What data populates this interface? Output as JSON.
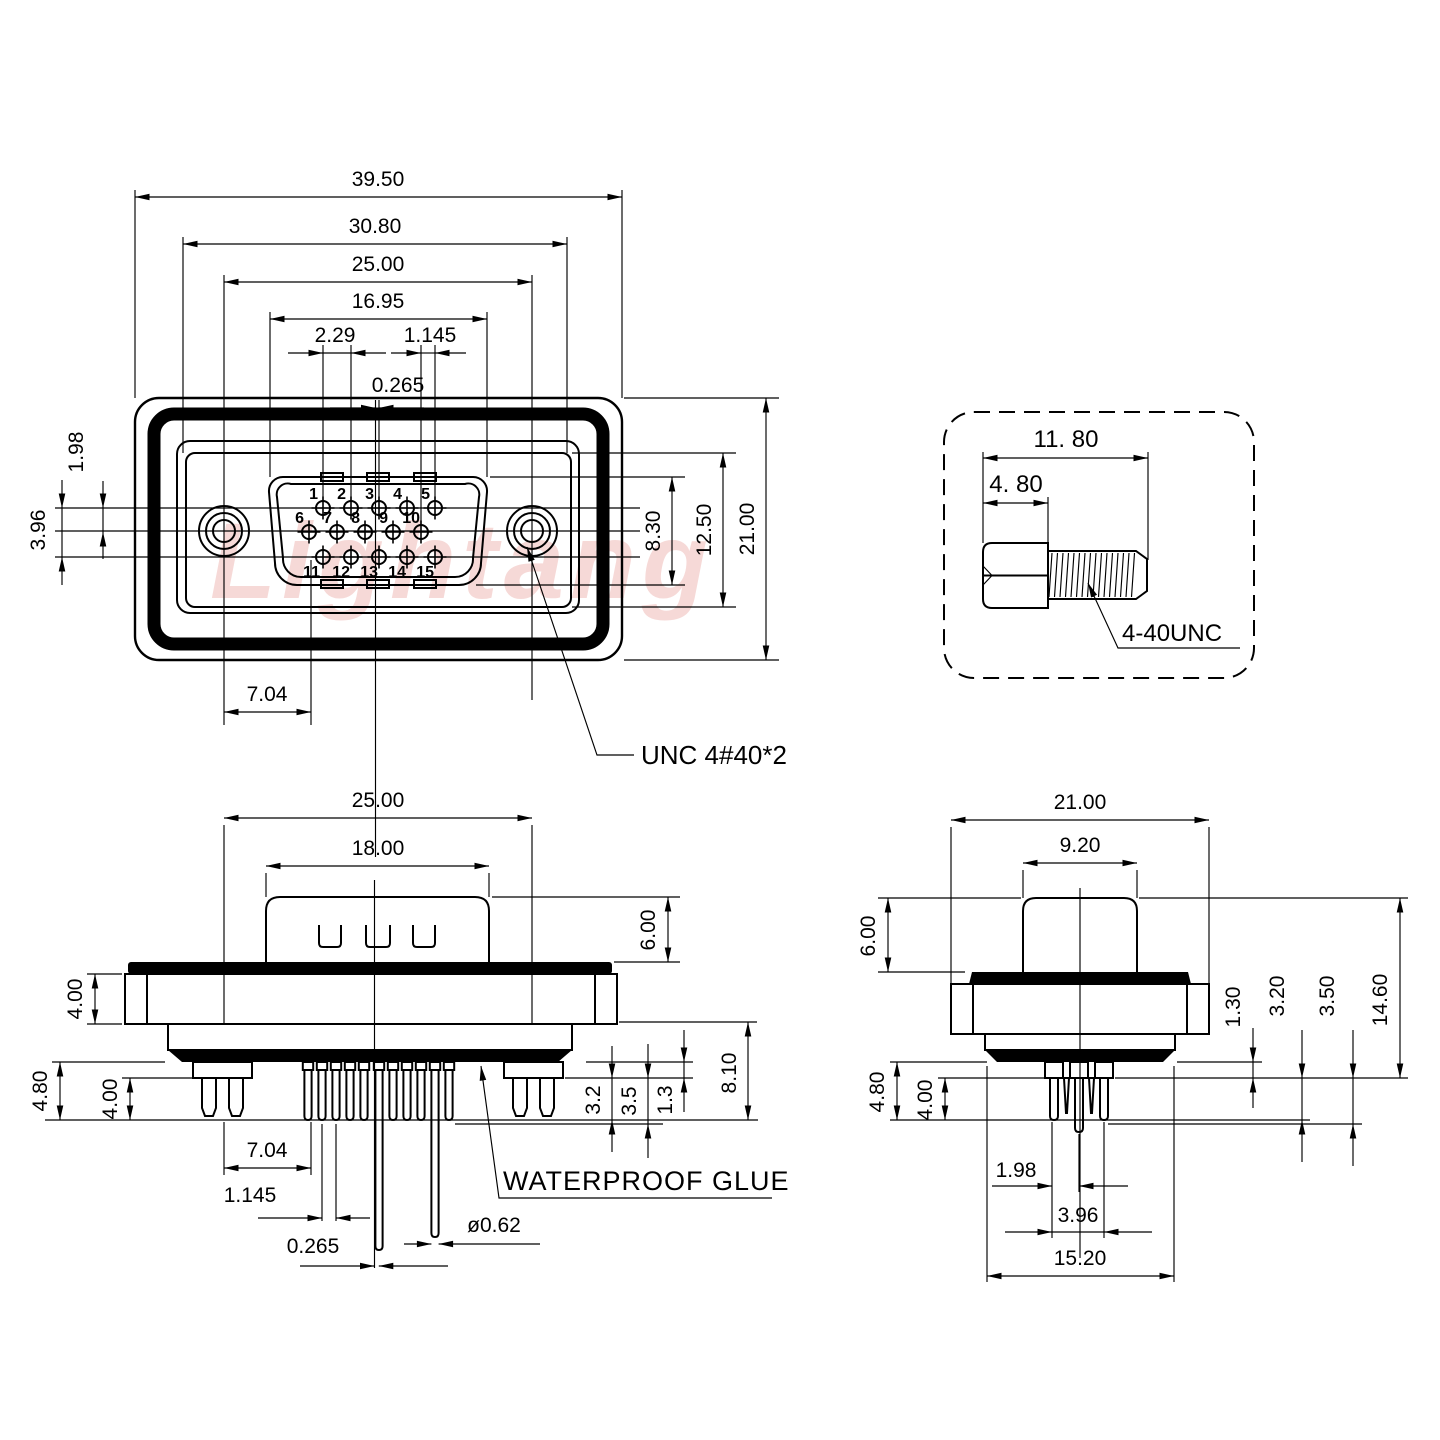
{
  "watermark": "Lightang",
  "front_view": {
    "dim_overall_width": "39.50",
    "dim_insert_outer_width": "30.80",
    "dim_screw_spacing": "25.00",
    "dim_shell_width": "16.95",
    "dim_pin_pitch": "2.29",
    "dim_row_offset": "1.145",
    "dim_center_offset": "0.265",
    "dim_row_spacing": "1.98",
    "dim_row_span": "3.96",
    "dim_shell_height": "8.30",
    "dim_insert_height": "12.50",
    "dim_overall_height": "21.00",
    "dim_screw_to_pin": "7.04",
    "screw_thread_label": "UNC 4#40*2",
    "pins": [
      "1",
      "2",
      "3",
      "4",
      "5",
      "6",
      "7",
      "8",
      "9",
      "10",
      "11",
      "12",
      "13",
      "14",
      "15"
    ]
  },
  "screw_detail": {
    "dim_total_length": "11. 80",
    "dim_head_length": "4. 80",
    "thread_label": "4-40UNC"
  },
  "front_section_view": {
    "dim_flange_width": "25.00",
    "dim_shell_width": "18.00",
    "dim_shell_height": "6.00",
    "dim_flange_thickness": "4.00",
    "dim_bracket_pin_length": "4.80",
    "dim_pin_length": "4.00",
    "dim_screw_to_pin": "7.04",
    "dim_pin_offset": "1.145",
    "dim_center_offset": "0.265",
    "dim_pin_diameter": "ø0.62",
    "dim_tail_1": "3.2",
    "dim_tail_2": "3.5",
    "dim_tail_3": "1.3",
    "dim_below_flange": "8.10",
    "glue_label": "WATERPROOF GLUE"
  },
  "side_section_view": {
    "dim_flange_width": "21.00",
    "dim_shell_width": "9.20",
    "dim_shell_height": "6.00",
    "dim_tail_1": "1.30",
    "dim_tail_2": "3.20",
    "dim_tail_3": "3.50",
    "dim_total_height": "14.60",
    "dim_bracket_pin_length": "4.80",
    "dim_pin_length": "4.00",
    "dim_row_spacing": "1.98",
    "dim_row_span": "3.96",
    "dim_glue_width": "15.20"
  }
}
